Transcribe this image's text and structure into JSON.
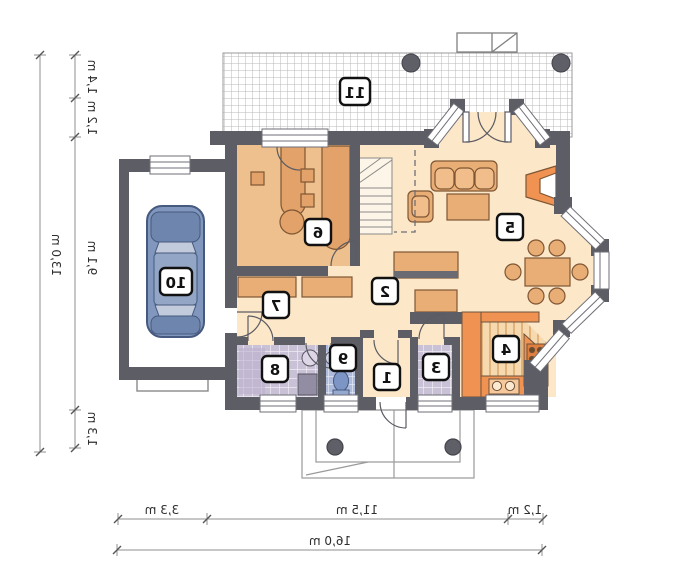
{
  "plan": {
    "type": "floor-plan",
    "mirrored": true,
    "rooms": [
      {
        "number": "1"
      },
      {
        "number": "2"
      },
      {
        "number": "3"
      },
      {
        "number": "4"
      },
      {
        "number": "5"
      },
      {
        "number": "6"
      },
      {
        "number": "7"
      },
      {
        "number": "8"
      },
      {
        "number": "9"
      },
      {
        "number": "10"
      },
      {
        "number": "11"
      }
    ],
    "dimensions": {
      "left_total": "13,0 m",
      "left_segments": [
        "1,4 m",
        "1,2 m",
        "9,1 m",
        "1,3 m"
      ],
      "bottom_segments": [
        "3,3 m",
        "11,5 m",
        "1,2 m"
      ],
      "bottom_total": "16,0 m"
    },
    "icons": [
      "car-icon",
      "toilet-icon",
      "washbasin-icon",
      "washer-icon",
      "stove-icon",
      "sink-icon",
      "fireplace-icon",
      "stairs-icon",
      "chimney-icon",
      "column-icon"
    ],
    "colors": {
      "wall": "#5d5d66",
      "floor_main": "#fce8c8",
      "floor_room6": "#eec08d",
      "furniture": "#e9ad76",
      "accent_orange": "#f09251",
      "tile_lilac": "#c9c1d6",
      "tile_blue": "#aebbdc",
      "car_blue": "#8197bd",
      "dimension_line": "#8f8f8f"
    }
  }
}
